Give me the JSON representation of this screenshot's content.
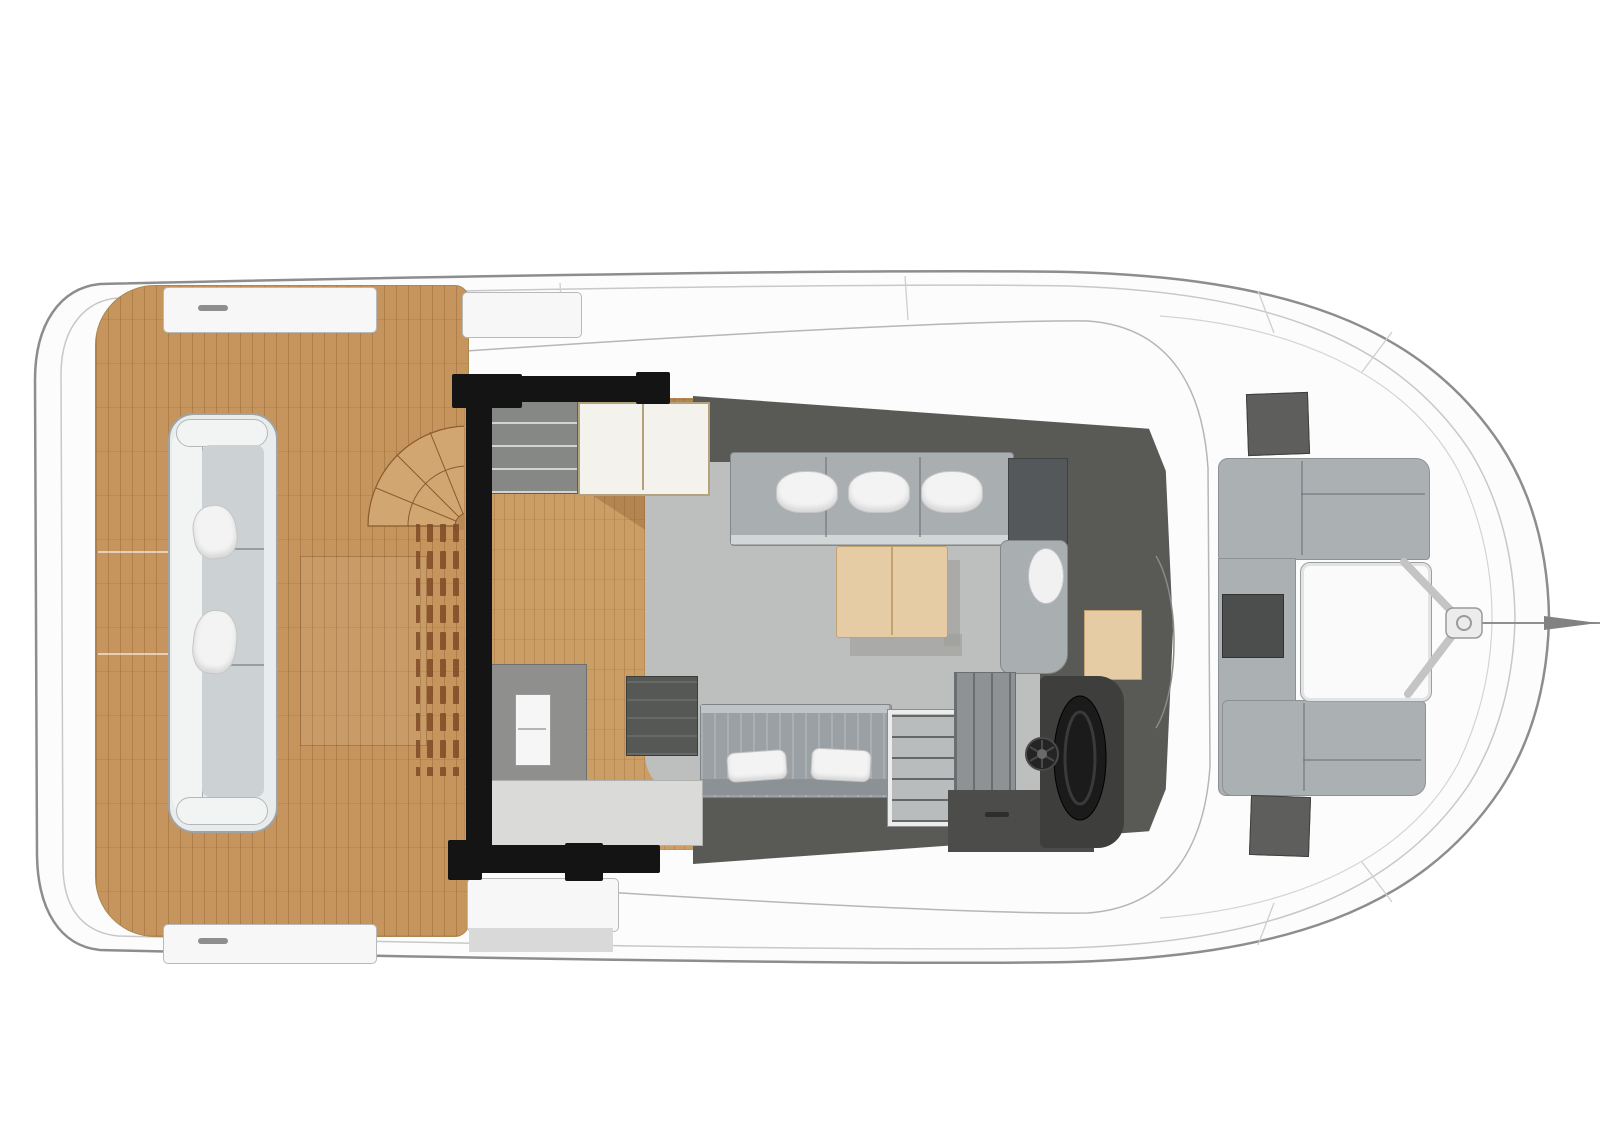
{
  "scene": {
    "type": "catamaran-yacht-deck-plan",
    "view": "top-down",
    "bow_direction": "right",
    "aft_deck": {
      "material": "teak",
      "sofa_pillow_count": 2,
      "has_spiral_staircase": true,
      "has_louvered_vents": true,
      "boarding_steps": 2
    },
    "salon": {
      "sofa_pillow_count": 3,
      "lower_sofa_pillow_count": 2,
      "has_coffee_table": true,
      "has_chaise_cushion": true
    },
    "galley": {
      "has_double_sink": true,
      "has_stove": true,
      "has_fridge_drawers": true,
      "white_cabinet_doors": 2
    },
    "helm": {
      "has_steering_wheel": true,
      "has_helm_seat": true,
      "has_companionway_stairs": true
    },
    "foredeck": {
      "bench_sections": 3,
      "has_white_table": true,
      "hatch_count": 2,
      "dark_locker_count": 2
    },
    "bow": {
      "has_bowsprit": true,
      "has_forestay_fitting": true
    }
  },
  "colors": {
    "hull_fill": "#fcfcfc",
    "hull_stroke": "#8d8d8d",
    "hull_inner": "#c8c8c8",
    "cabin_line": "#b6b6b6",
    "deck_teak": "#c6955e",
    "stair_teak": "#d2a670",
    "vent_slat": "#7d4a26",
    "door_black": "#141414",
    "wall_charcoal": "#595956",
    "floor_gray": "#bdbfbe",
    "floor_wood": "#cb9e66",
    "seat_gray": "#a9aeb1",
    "seat_edge": "#83878a",
    "pillow_white": "#f3f3f3",
    "table_tan": "#e6cca5",
    "table_trim": "#c2a271",
    "cabinet_white": "#f4f2ed",
    "cabinet_trim": "#b3a27c",
    "drawer_gray": "#868886",
    "counter_gray": "#8f8f8d",
    "counter_light": "#dadad8",
    "sink_white": "#f6f6f6",
    "stove_dark": "#565856",
    "stairs_gray": "#b9bcbc",
    "nav_gray": "#8e9294",
    "console_dark": "#4c4c4a",
    "helm_dark": "#3e3e3c",
    "wheel_black": "#1b1b1b",
    "fore_seat": "#abb0b3",
    "fore_table": "#fafafa",
    "hatch_dark": "#5e5e5c",
    "fore_darkbox": "#4c4e4e",
    "step_white": "#f7f7f7",
    "shadow_gray": "#9c9c9a",
    "aft_sofa_shell": "#e9ecec",
    "aft_sofa_seat": "#ccd1d3"
  }
}
